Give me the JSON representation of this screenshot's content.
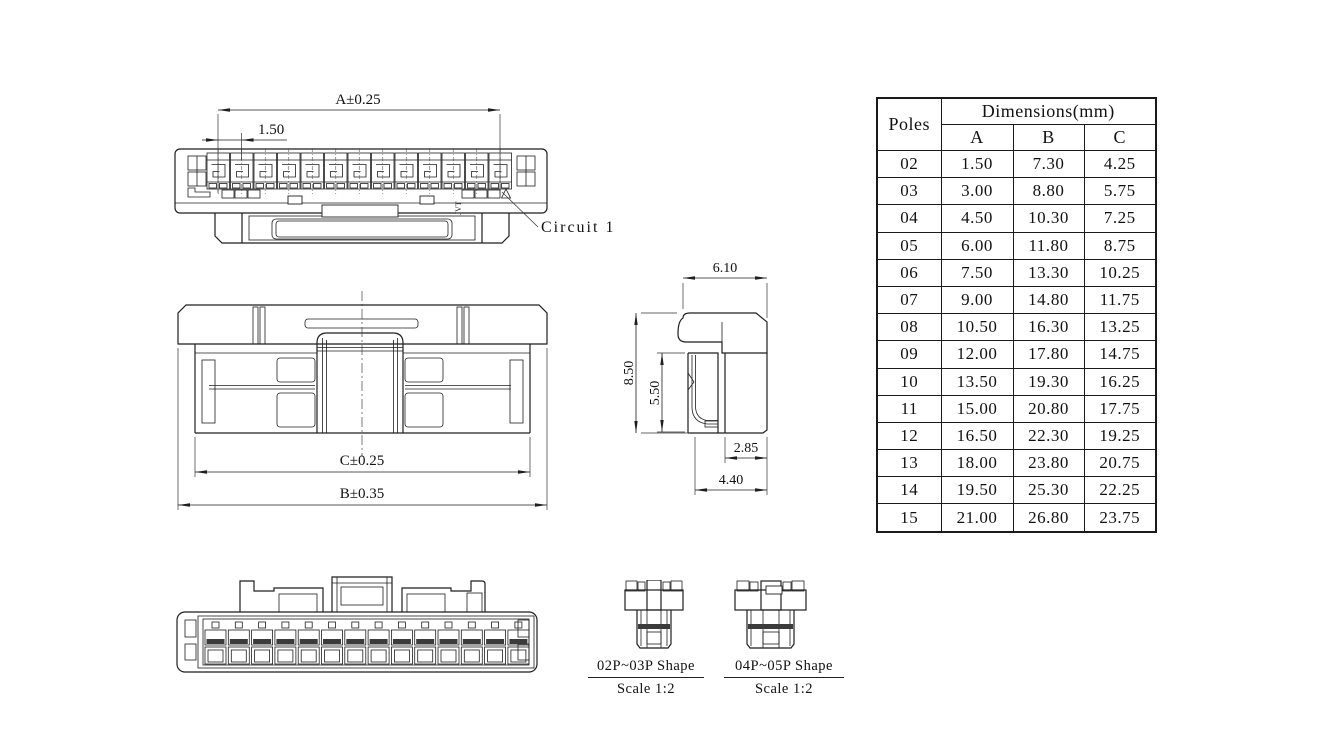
{
  "sheet": {
    "background": "#ffffff",
    "line_color": "#1f1f1f"
  },
  "front_view": {
    "dim_width": "A±0.25",
    "dim_pitch": "1.50",
    "circuit_label": "Circuit 1",
    "brand_mark": "JVT",
    "cavity_count": 13
  },
  "plan_view": {
    "dim_inner_width": "C±0.25",
    "dim_outer_width": "B±0.35"
  },
  "side_view": {
    "dim_top_width": "6.10",
    "dim_total_height": "8.50",
    "dim_body_height": "5.50",
    "dim_lower_width": "2.85",
    "dim_base_width": "4.40"
  },
  "rear_view": {
    "slot_count": 14
  },
  "shape_variants": [
    {
      "label": "02P~03P Shape",
      "scale": "Scale 1:2"
    },
    {
      "label": "04P~05P Shape",
      "scale": "Scale 1:2"
    }
  ],
  "table": {
    "header": {
      "poles": "Poles",
      "dimensions": "Dimensions(mm)",
      "columns": [
        "A",
        "B",
        "C"
      ]
    },
    "rows": [
      [
        "02",
        "1.50",
        "7.30",
        "4.25"
      ],
      [
        "03",
        "3.00",
        "8.80",
        "5.75"
      ],
      [
        "04",
        "4.50",
        "10.30",
        "7.25"
      ],
      [
        "05",
        "6.00",
        "11.80",
        "8.75"
      ],
      [
        "06",
        "7.50",
        "13.30",
        "10.25"
      ],
      [
        "07",
        "9.00",
        "14.80",
        "11.75"
      ],
      [
        "08",
        "10.50",
        "16.30",
        "13.25"
      ],
      [
        "09",
        "12.00",
        "17.80",
        "14.75"
      ],
      [
        "10",
        "13.50",
        "19.30",
        "16.25"
      ],
      [
        "11",
        "15.00",
        "20.80",
        "17.75"
      ],
      [
        "12",
        "16.50",
        "22.30",
        "19.25"
      ],
      [
        "13",
        "18.00",
        "23.80",
        "20.75"
      ],
      [
        "14",
        "19.50",
        "25.30",
        "22.25"
      ],
      [
        "15",
        "21.00",
        "26.80",
        "23.75"
      ]
    ]
  }
}
